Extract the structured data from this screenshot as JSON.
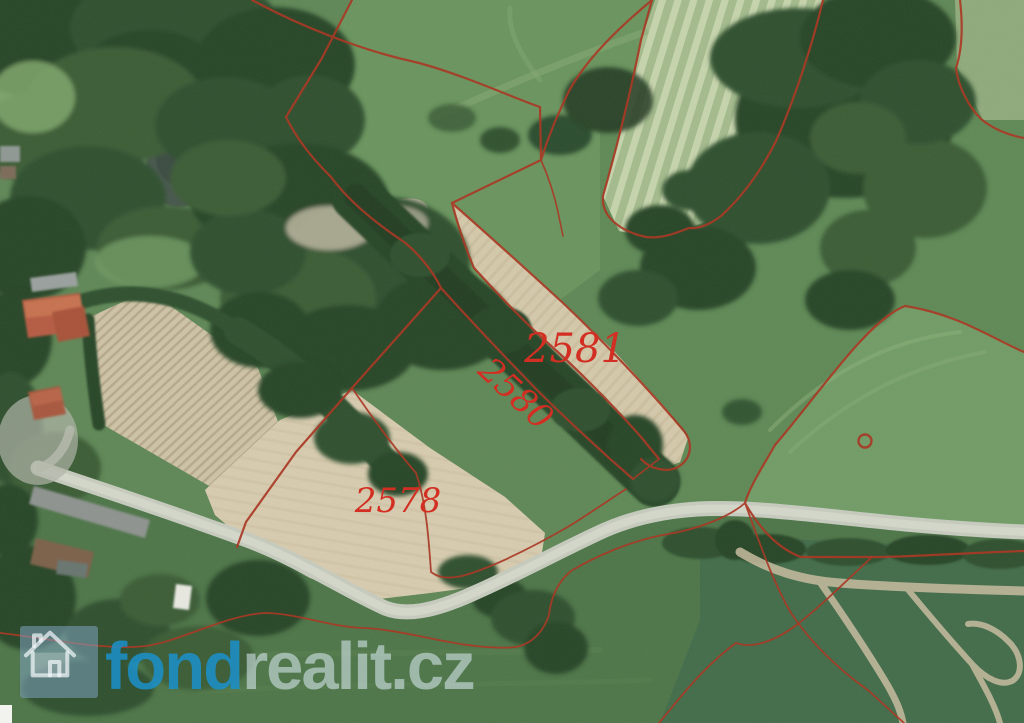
{
  "map": {
    "type": "aerial-orthophoto-with-cadastral-overlay",
    "boundary_color": "#a93420",
    "parcel_label_color": "#d5281c"
  },
  "parcels": [
    {
      "number": "2581"
    },
    {
      "number": "2580"
    },
    {
      "number": "2578"
    }
  ],
  "watermark": {
    "icon": "house-icon",
    "brand_bold": "fond",
    "brand_light": "realit.cz",
    "brand_bold_color": "#1b90cb",
    "brand_light_color": "#d8e7f0"
  }
}
